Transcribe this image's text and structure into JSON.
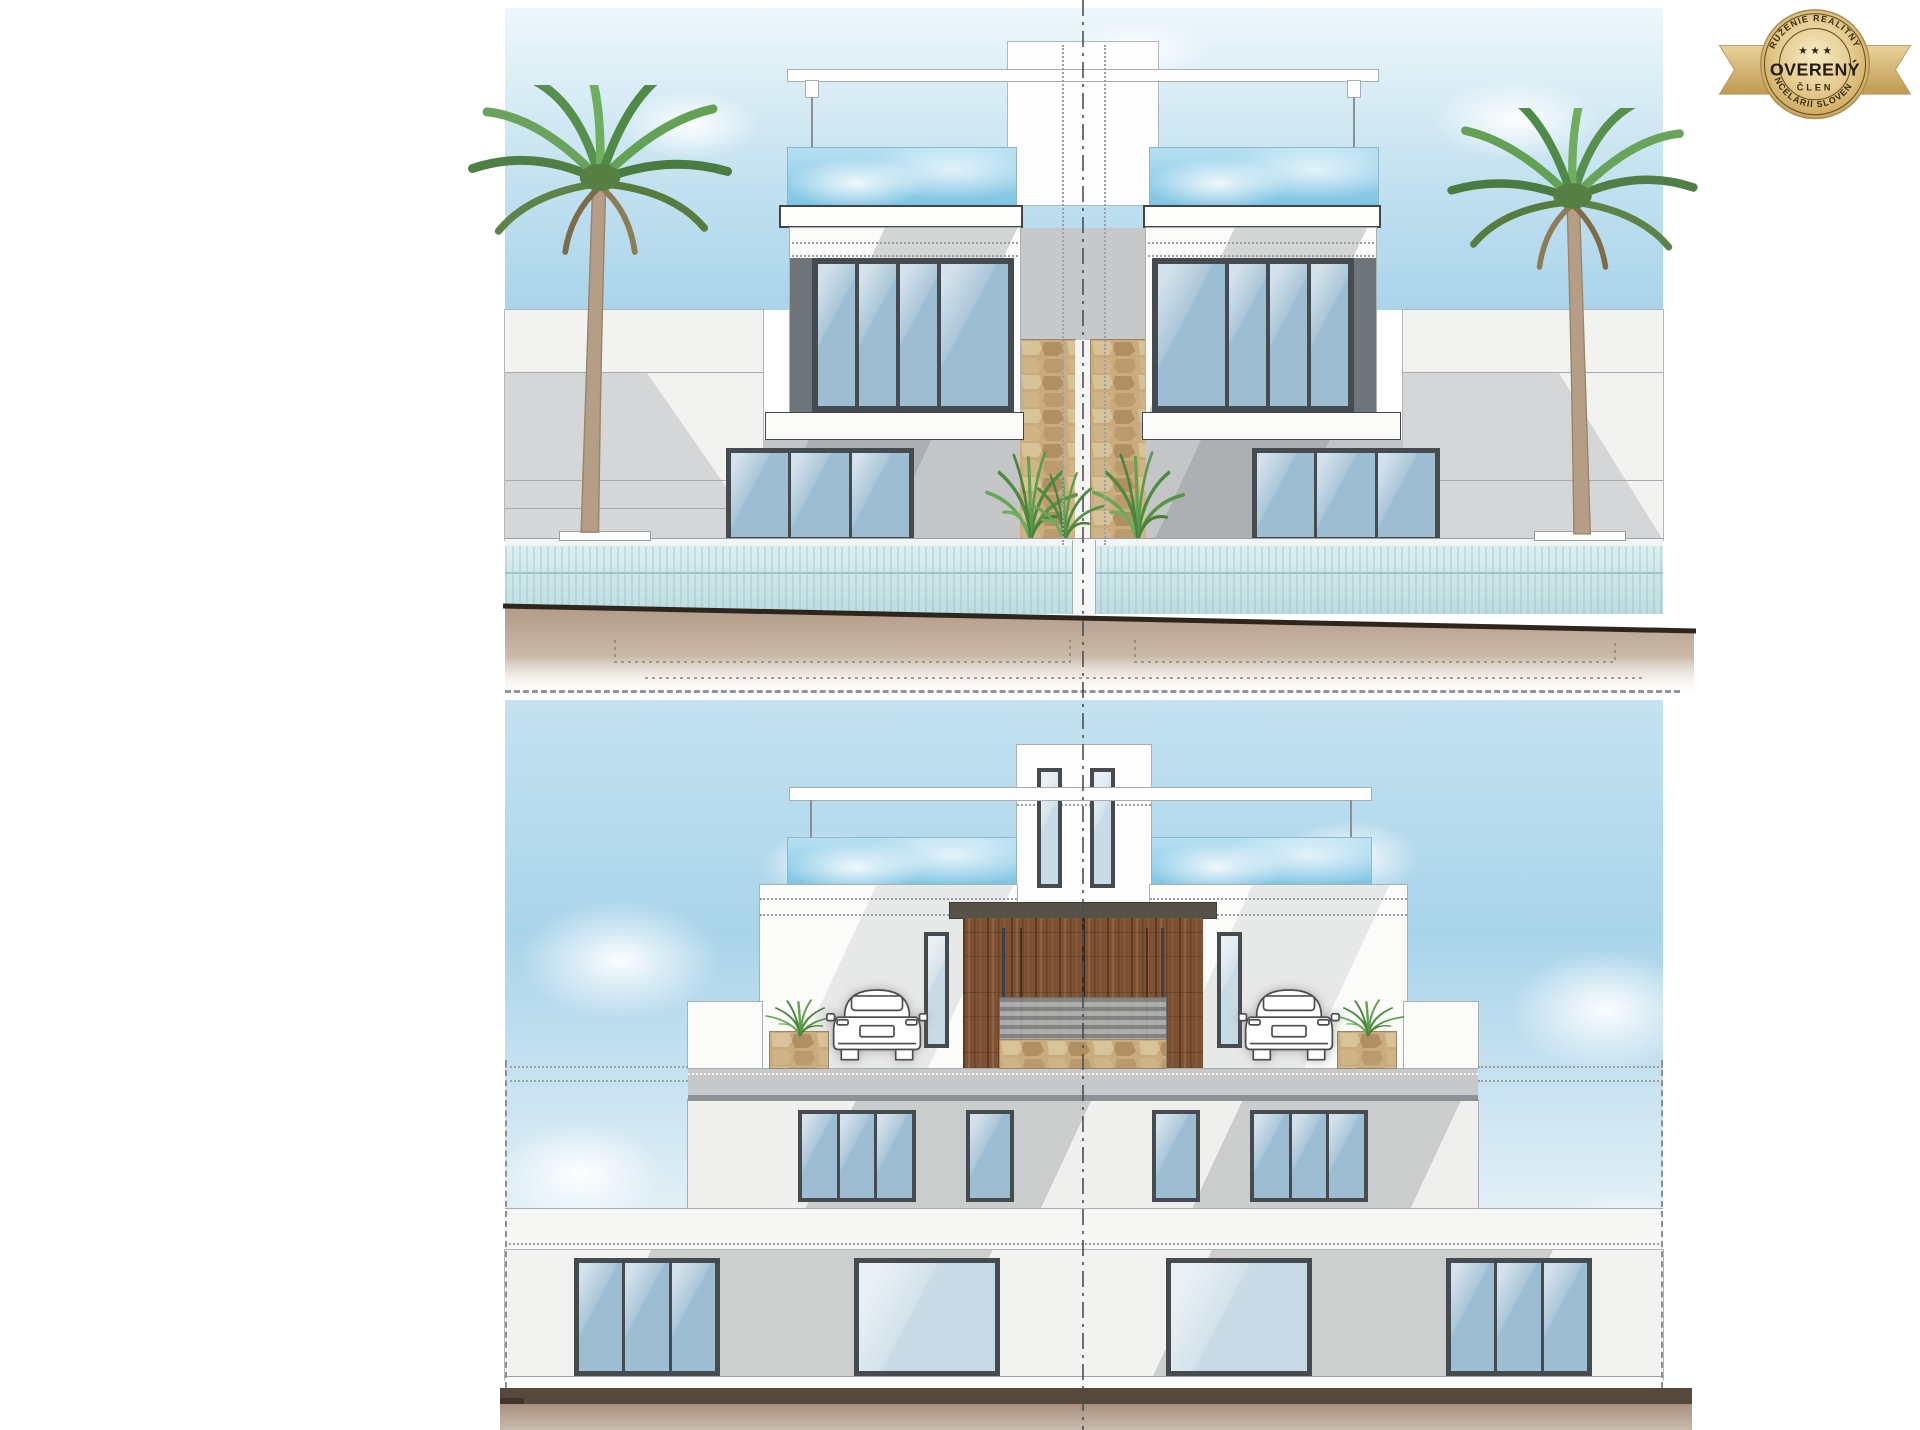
{
  "badge": {
    "arc_top": "ZDRUŽENIE REALITNÝCH",
    "arc_bottom": "KANCELÁRIÍ SLOVENSKA",
    "title": "OVERENÝ",
    "subtitle": "ČLEN",
    "stars": "★ ★ ★"
  },
  "colors": {
    "sky_top": "#eef7fb",
    "sky_mid": "#c4e2f0",
    "sky_deep": "#a9d4ea",
    "glass_rail": "#7fc4e3",
    "glass_rail_light": "#b5e0f2",
    "window_frame": "#464b50",
    "window_glass": "#9cbdd2",
    "window_glass_light": "#c9dbe6",
    "wall_white": "#fbfbfa",
    "wall_gray": "#c3c5c7",
    "wall_dark": "#6f7478",
    "fascia_line": "#41464b",
    "stone": "#c9ab7e",
    "wood": "#7d5134",
    "pool_water": "#cfe7ea",
    "earth": "#b29a87",
    "ground_dark": "#56493b",
    "earth_low": "#a78f7e",
    "badge_gold": "#e3c88b",
    "badge_text": "#2e2510",
    "line_gray": "#9aa0a4"
  }
}
